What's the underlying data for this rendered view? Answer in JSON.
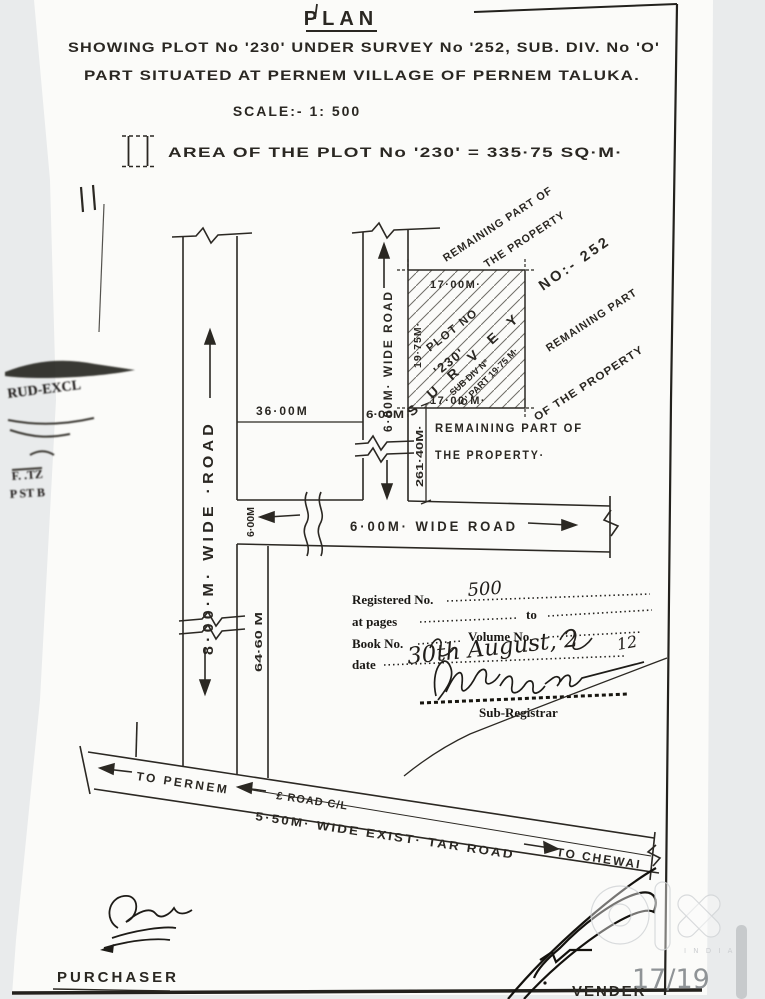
{
  "header": {
    "title": "PLAN",
    "line1": "SHOWING PLOT No '230' UNDER SURVEY No '252, SUB. DIV. No 'O'",
    "line2": "PART SITUATED AT PERNEM VILLAGE OF PERNEM TALUKA.",
    "scale": "SCALE:- 1: 500",
    "legend_label": "AREA OF THE PLOT No '230' = 335·75 SQ·M·"
  },
  "plot": {
    "dim_top": "17·00M·",
    "dim_bottom": "17·00 M·",
    "dim_left": "19·75M·",
    "name_line1": "PLOT NO",
    "name_line2": "'230'",
    "survey": "S U R V E Y",
    "survey_no": "NO:- 252",
    "subdiv": "SUB DIV Nº",
    "opart": "'O' PART 19·75 M·"
  },
  "roads": {
    "left": "8·00·M· WIDE ·ROAD",
    "top": "6·00M· WIDE ROAD",
    "horizontal": "6·00M· WIDE ROAD",
    "tar": "5·50M· WIDE EXIST· TAR ROAD",
    "cl": "£ ROAD C/L",
    "to_pernem": "TO PERNEM",
    "to_chewai": "TO CHEWAI"
  },
  "dims": {
    "d36": "36·00M",
    "d6_top": "6·00M",
    "d6_left": "6·00M",
    "d261": "261·40M·",
    "d64": "64·60 M"
  },
  "remaining": {
    "top1": "REMAINING PART OF",
    "top2": "THE PROPERTY",
    "right1": "REMAINING PART",
    "right2": "OF THE PROPERTY",
    "below1": "REMAINING PART OF",
    "below2": "THE PROPERTY·"
  },
  "registration": {
    "registered_label": "Registered No.",
    "registered_value": "500",
    "at_pages_label": "at pages",
    "to_label": "to",
    "book_no_label": "Book No.",
    "volume_no_label": "Volume No.",
    "date_label": "date",
    "date_value": "30th August, 2",
    "date_suffix": "12",
    "sub_registrar": "Sub-Registrar"
  },
  "stamp": {
    "l1": "RUD-EXCL",
    "l2": "F. .TZ",
    "l3": "P ST B"
  },
  "footer": {
    "purchaser": "PURCHASER",
    "vendor": "VENDER",
    "page": "17/19"
  },
  "watermark": {
    "country": "I N D I A"
  },
  "colors": {
    "ink": "#2b2823",
    "paper": "#fbfbf9",
    "scan_bg": "#e9ebec",
    "watermark": "#d2d5d7"
  }
}
